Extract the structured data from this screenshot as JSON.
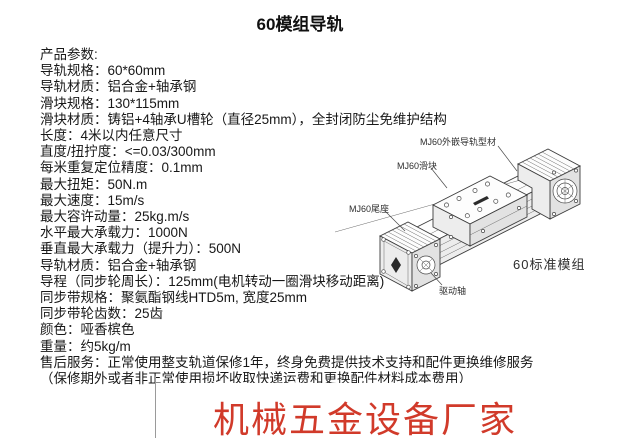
{
  "title": "60模组导轨",
  "params": {
    "heading": "产品参数:",
    "lines": [
      "导轨规格：60*60mm",
      "导轨材质：铝合金+轴承钢",
      "滑块规格：130*115mm",
      "滑块材质：铸铝+4轴承U槽轮（直径25mm），全封闭防尘免维护结构",
      "长度：4米以内任意尺寸",
      "直度/扭拧度：<=0.03/300mm",
      "每米重复定位精度：0.1mm",
      "最大扭矩：50N.m",
      "最大速度：15m/s",
      "最大容许动量：25kg.m/s",
      "水平最大承载力：1000N",
      "垂直最大承载力（提升力）：500N",
      "导轨材质：铝合金+轴承钢",
      "导程（同步轮周长）：125mm(电机转动一圈滑块移动距离)",
      "同步带规格：聚氨酯钢线HTD5m, 宽度25mm",
      "同步带轮齿数：25齿",
      "颜色：哑香槟色",
      "重量：约5kg/m",
      "售后服务：正常使用整支轨道保修1年，终身免费提供技术支持和配件更换维修服务",
      "（保修期外或者非正常使用损坏收取快递运费和更换配件材料成本费用）"
    ]
  },
  "diagram": {
    "labels": {
      "rail": "MJ60外嵌导轨型材",
      "slider": "MJ60滑块",
      "tail": "MJ60尾座",
      "shaft": "驱动轴",
      "caption": "60标准模组"
    }
  },
  "watermark": {
    "text": "机械五金设备厂家",
    "color": "#d13a2a"
  }
}
